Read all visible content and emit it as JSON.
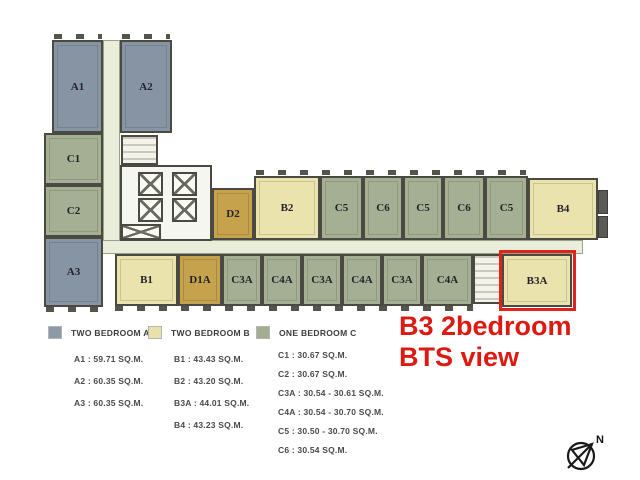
{
  "plan": {
    "units": [
      {
        "label": "A1",
        "type": "A",
        "x": 52,
        "y": 40,
        "w": 51,
        "h": 93
      },
      {
        "label": "A2",
        "type": "A",
        "x": 120,
        "y": 40,
        "w": 52,
        "h": 93
      },
      {
        "label": "C1",
        "type": "C",
        "x": 44,
        "y": 133,
        "w": 59,
        "h": 52
      },
      {
        "label": "C2",
        "type": "C",
        "x": 44,
        "y": 185,
        "w": 59,
        "h": 52
      },
      {
        "label": "A3",
        "type": "A",
        "x": 44,
        "y": 237,
        "w": 59,
        "h": 70
      },
      {
        "label": "D2",
        "type": "D",
        "x": 212,
        "y": 188,
        "w": 42,
        "h": 52
      },
      {
        "label": "B2",
        "type": "B",
        "x": 254,
        "y": 176,
        "w": 66,
        "h": 64
      },
      {
        "label": "C5",
        "type": "C",
        "x": 320,
        "y": 176,
        "w": 43,
        "h": 64
      },
      {
        "label": "C6",
        "type": "C",
        "x": 363,
        "y": 176,
        "w": 40,
        "h": 64
      },
      {
        "label": "C5",
        "type": "C",
        "x": 403,
        "y": 176,
        "w": 40,
        "h": 64
      },
      {
        "label": "C6",
        "type": "C",
        "x": 443,
        "y": 176,
        "w": 42,
        "h": 64
      },
      {
        "label": "C5",
        "type": "C",
        "x": 485,
        "y": 176,
        "w": 43,
        "h": 64
      },
      {
        "label": "B4",
        "type": "B",
        "x": 528,
        "y": 178,
        "w": 70,
        "h": 62
      },
      {
        "label": "B1",
        "type": "B",
        "x": 115,
        "y": 254,
        "w": 63,
        "h": 52
      },
      {
        "label": "D1A",
        "type": "D",
        "x": 178,
        "y": 254,
        "w": 44,
        "h": 52
      },
      {
        "label": "C3A",
        "type": "C",
        "x": 222,
        "y": 254,
        "w": 40,
        "h": 52
      },
      {
        "label": "C4A",
        "type": "C",
        "x": 262,
        "y": 254,
        "w": 40,
        "h": 52
      },
      {
        "label": "C3A",
        "type": "C",
        "x": 302,
        "y": 254,
        "w": 40,
        "h": 52
      },
      {
        "label": "C4A",
        "type": "C",
        "x": 342,
        "y": 254,
        "w": 40,
        "h": 52
      },
      {
        "label": "C3A",
        "type": "C",
        "x": 382,
        "y": 254,
        "w": 40,
        "h": 52
      },
      {
        "label": "C4A",
        "type": "C",
        "x": 422,
        "y": 254,
        "w": 51,
        "h": 52
      },
      {
        "label": "B3A",
        "type": "B",
        "x": 502,
        "y": 254,
        "w": 70,
        "h": 53
      }
    ],
    "highlighted_unit": "B3A"
  },
  "colors": {
    "A": "#8794a4",
    "B": "#ebe3ad",
    "C": "#a5af93",
    "D": "#c5a24b",
    "corridor": "#e8eeda",
    "highlight": "#e2231a"
  },
  "legend": {
    "groups": [
      {
        "swatch": "#8e99a7",
        "title": "TWO BEDROOM A",
        "items": [
          "A1 : 59.71 SQ.M.",
          "A2 : 60.35 SQ.M.",
          "A3 : 60.35 SQ.M."
        ]
      },
      {
        "swatch": "#e8e1a9",
        "title": "TWO BEDROOM B",
        "items": [
          "B1 : 43.43 SQ.M.",
          "B2 : 43.20 SQ.M.",
          "B3A : 44.01 SQ.M.",
          "B4 : 43.23 SQ.M."
        ]
      },
      {
        "swatch": "#a3ae91",
        "title": "ONE BEDROOM C",
        "items": [
          "C1 : 30.67 SQ.M.",
          "C2 : 30.67 SQ.M.",
          "C3A : 30.54 - 30.61 SQ.M.",
          "C4A : 30.54 - 30.70 SQ.M.",
          "C5 : 30.50 - 30.70 SQ.M.",
          "C6 : 30.54 SQ.M."
        ]
      }
    ]
  },
  "annotation": {
    "line1": "B3 2bedroom",
    "line2": "BTS view",
    "color": "#dd1a12"
  },
  "compass": {
    "label": "N"
  }
}
